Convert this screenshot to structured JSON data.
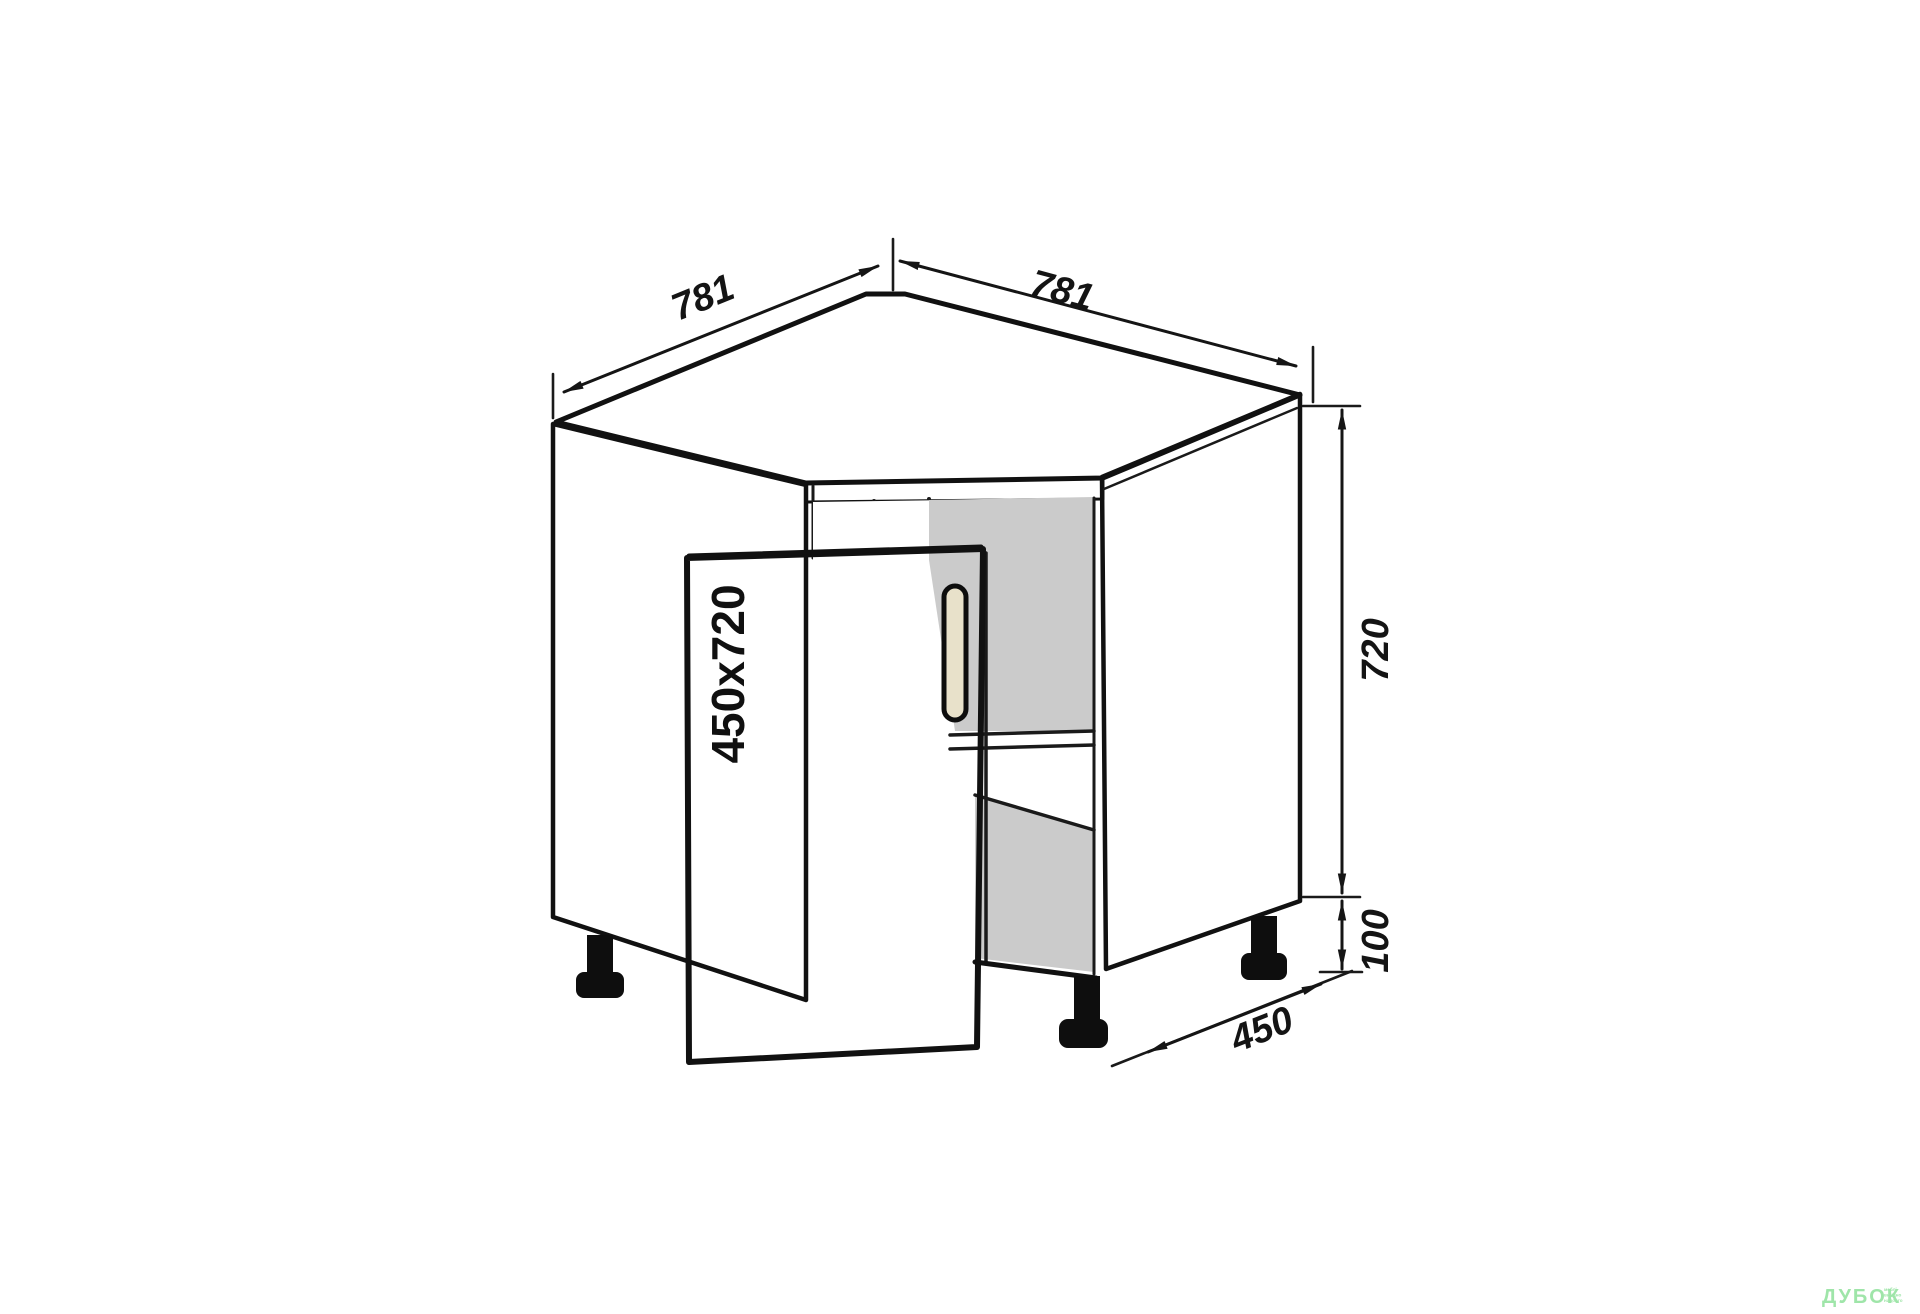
{
  "dimensions": {
    "top_left_width": "781",
    "top_right_width": "781",
    "body_height": "720",
    "leg_height": "100",
    "side_depth": "450",
    "door_size": "450x720"
  },
  "watermark": {
    "brand": "ДУБОК",
    "tagline": [
      "меблі",
      "вигідно",
      "надовго"
    ]
  },
  "colors": {
    "panel_gray": "#c9c9c9",
    "interior_gray": "#cbcbcb",
    "door_beige": "#d6cdb3",
    "handle_fill": "#e8e1ca",
    "leg_black": "#0e0e0e",
    "watermark_green": "#9fe5a9"
  }
}
